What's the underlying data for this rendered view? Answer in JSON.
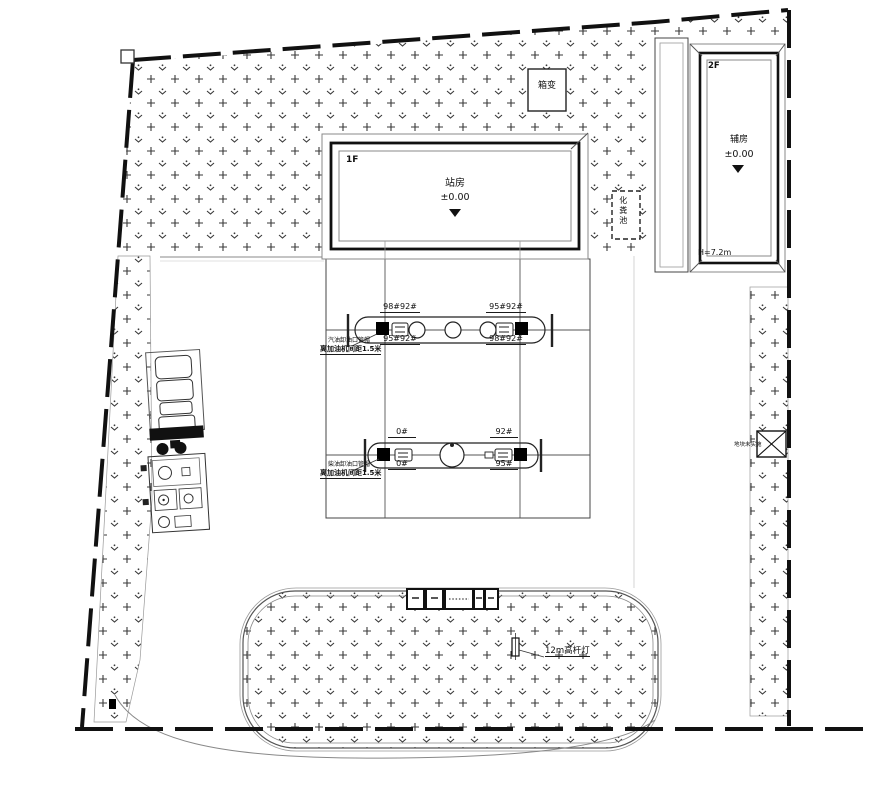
{
  "labels": {
    "transformer": "箱变",
    "station": {
      "floor": "1F",
      "name": "站房",
      "elevation": "±0.00"
    },
    "auxiliary": {
      "floor": "2F",
      "name": "辅房",
      "elevation": "±0.00",
      "height": "H=7.2m"
    },
    "septic_tank": "化粪池",
    "island_row1": {
      "top_left": "98#92#",
      "bottom_left": "95#92#",
      "top_right": "95#92#",
      "bottom_right": "98#92#",
      "note_line1": "汽油卸油口管帽",
      "note_line2": "离加油机间距1.5米"
    },
    "island_row2": {
      "top_left": "0#",
      "bottom_left": "0#",
      "top_right": "92#",
      "bottom_right": "95#",
      "note_line1": "柴油卸油口管帽",
      "note_line2": "离加油机间距1.5米"
    },
    "light_pole": "12m高杆灯",
    "right_strip_note": "地块未实施"
  },
  "colors": {
    "ink": "#111111",
    "hatch_mark": "#3a3a3a"
  }
}
